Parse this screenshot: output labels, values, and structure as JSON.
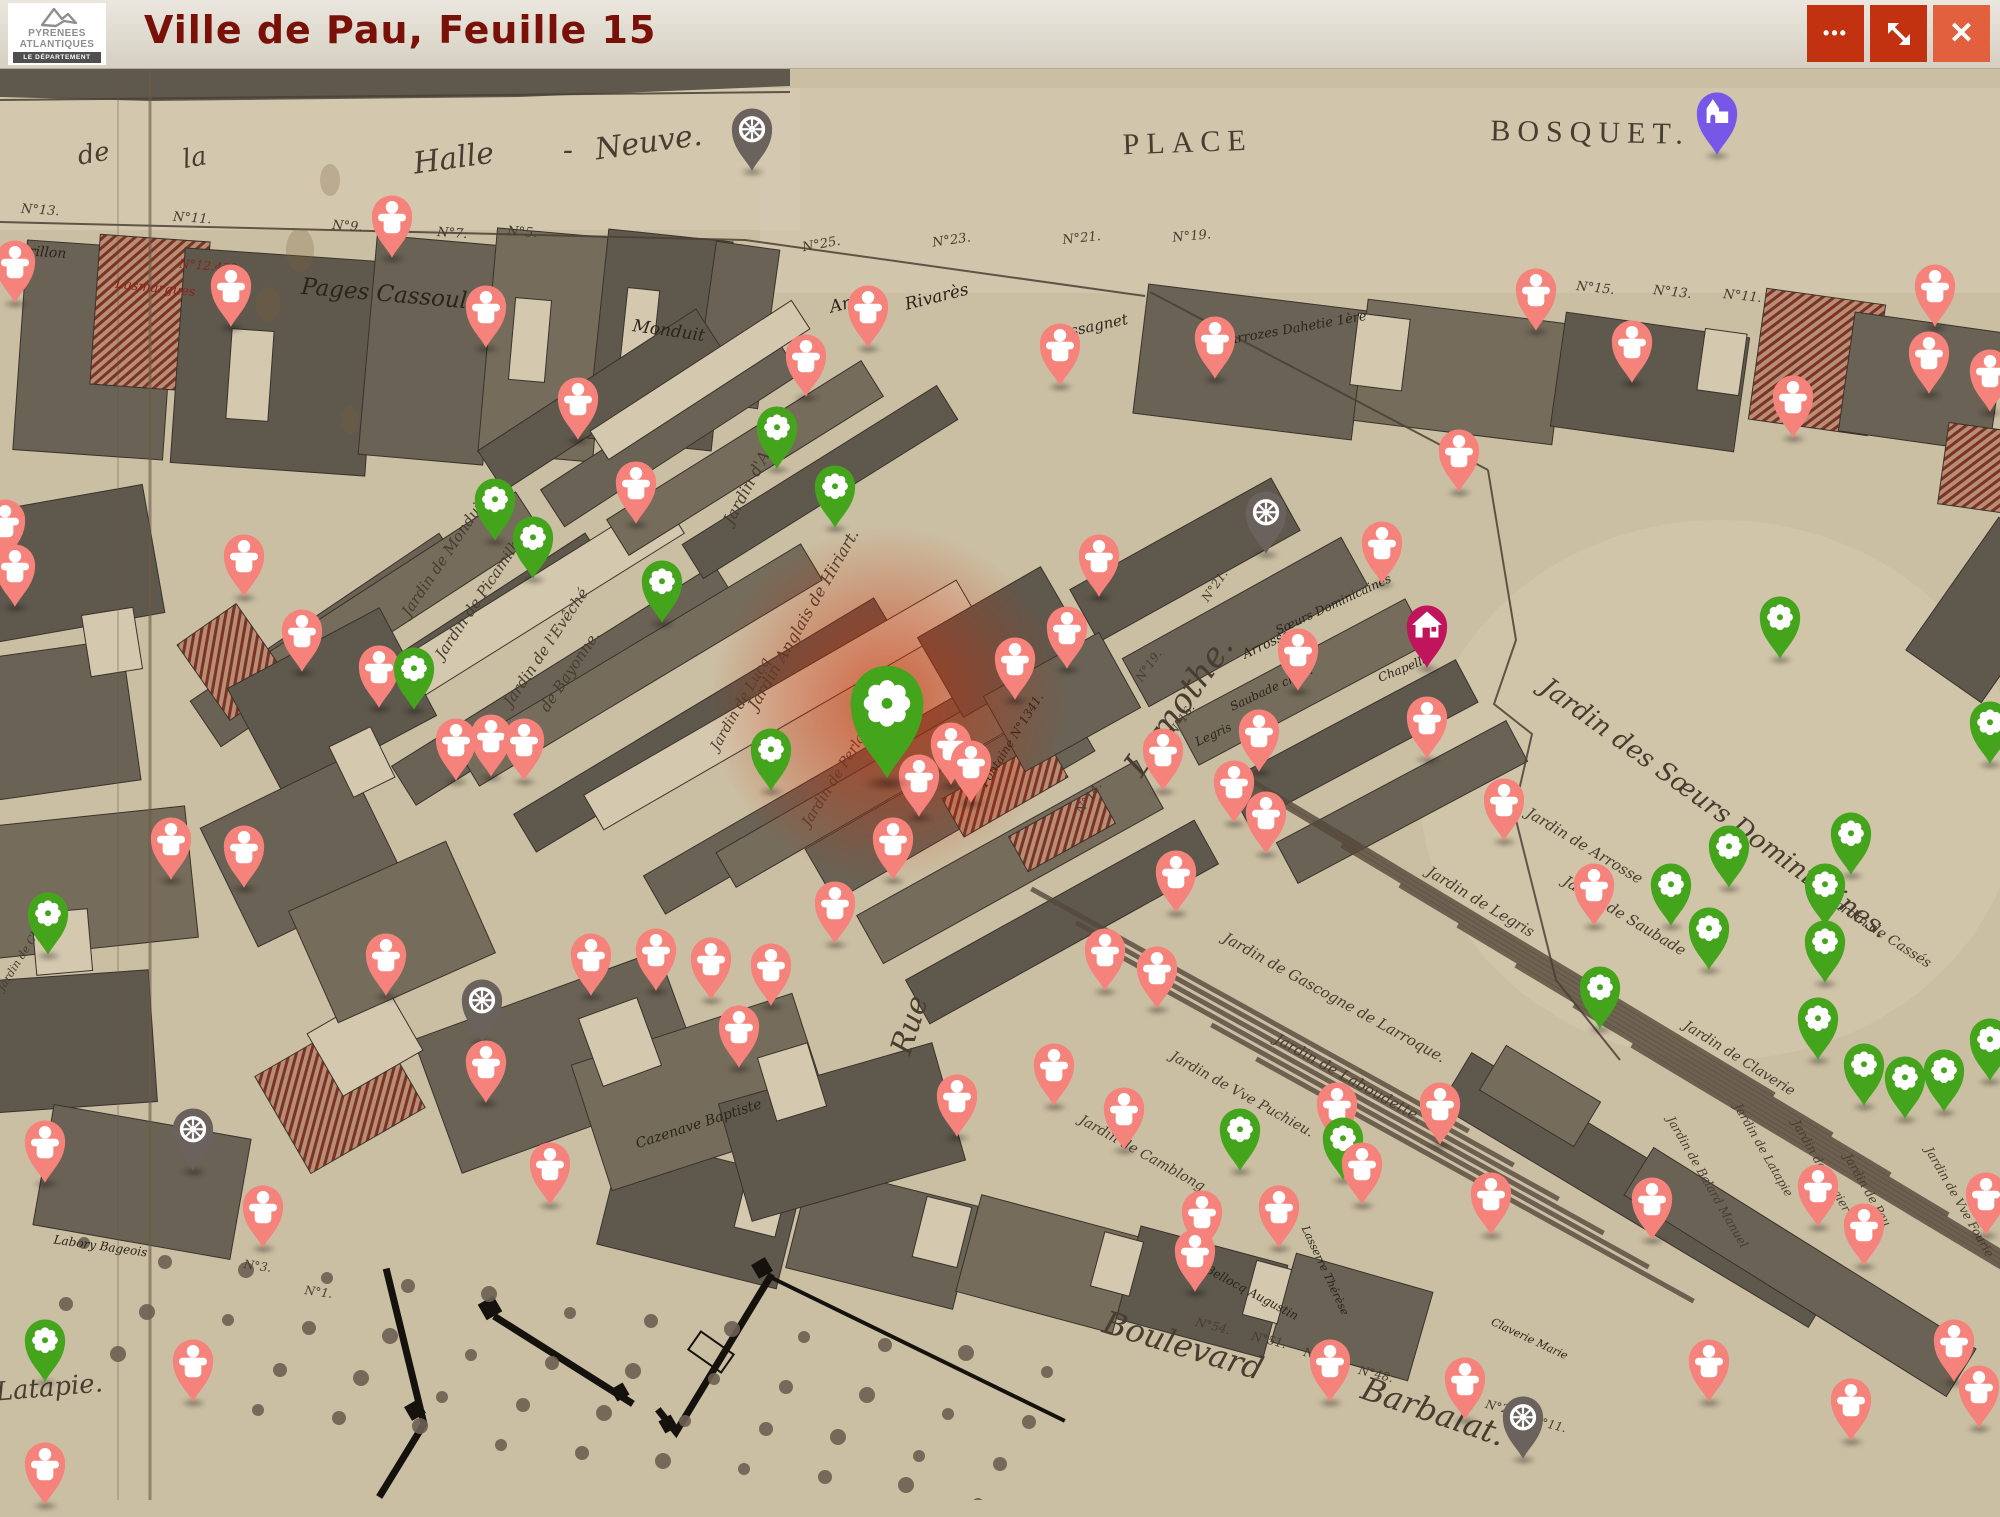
{
  "header": {
    "title": "Ville de Pau, Feuille 15",
    "logo": {
      "line1": "PYRENEES",
      "line2": "ATLANTIQUES",
      "line3": "LE DÉPARTEMENT"
    },
    "controls": {
      "more": {
        "label": "More options",
        "glyph": "•••",
        "icon": "more-options-icon"
      },
      "fullscreen": {
        "label": "Toggle fullscreen",
        "icon": "fullscreen-arrows-icon"
      },
      "close": {
        "label": "Close",
        "glyph": "✕",
        "icon": "close-icon"
      }
    }
  },
  "colors": {
    "header_bg": "#ddd7c9",
    "title": "#7a1108",
    "button": "#c23210",
    "button_close": "#e2603e",
    "paper": "#cbbfa3",
    "ink": "#473d30",
    "pin_person": "#F5837B",
    "pin_flower": "#44A41C",
    "pin_wheel": "#6B625D",
    "pin_church": "#7757E8",
    "pin_house": "#C0155C",
    "highlight_glow": "#CD2A04"
  },
  "map": {
    "labels": [
      [
        "de",
        95,
        162,
        26,
        -10,
        "s"
      ],
      [
        "la",
        196,
        166,
        26,
        -10,
        "s"
      ],
      [
        "Halle",
        455,
        168,
        30,
        -8,
        "s"
      ],
      [
        "-",
        568,
        160,
        30,
        0,
        "s"
      ],
      [
        "Neuve.",
        650,
        152,
        30,
        -8,
        "s"
      ],
      [
        "PLACE",
        1188,
        152,
        30,
        -2,
        "c"
      ],
      [
        "BOSQUET.",
        1590,
        142,
        30,
        1,
        "c"
      ],
      [
        "Pages Cassoulat",
        395,
        302,
        23,
        5,
        "s",
        "d"
      ],
      [
        "Monduit",
        668,
        336,
        17,
        8,
        "s",
        "d"
      ],
      [
        "Arriou",
        858,
        306,
        17,
        -14,
        "s",
        "d"
      ],
      [
        "Rivarès",
        938,
        302,
        17,
        -14,
        "s",
        "d"
      ],
      [
        "Cassagnet",
        1090,
        332,
        15,
        -12,
        "s",
        "d"
      ],
      [
        "Arrozes Dahetie 1ère",
        1298,
        332,
        13,
        -10,
        "s",
        "d"
      ],
      [
        "Merillon",
        36,
        256,
        14,
        4,
        "s",
        "d"
      ],
      [
        "Lasmargues",
        155,
        292,
        13,
        6,
        "s",
        "r"
      ],
      [
        "N°12.433",
        208,
        270,
        12,
        5,
        "n",
        "r"
      ],
      [
        "Lamothe.",
        1188,
        712,
        34,
        -55,
        "s"
      ],
      [
        "Rue",
        919,
        1028,
        30,
        -72,
        "s"
      ],
      [
        "Boulevard",
        1180,
        1356,
        32,
        17,
        "s"
      ],
      [
        "Barbalat.",
        1430,
        1422,
        32,
        19,
        "s"
      ],
      [
        "Latapie.",
        50,
        1396,
        26,
        -5,
        "s"
      ],
      [
        "Jardin des Sœurs Dominicaines.",
        1710,
        815,
        26,
        36,
        "s"
      ],
      [
        "Jardin de Monduit",
        448,
        560,
        15,
        -56,
        "s"
      ],
      [
        "Jardin de Picamilh",
        482,
        602,
        15,
        -56,
        "s"
      ],
      [
        "Jardin de l'Evêché",
        550,
        650,
        15,
        -56,
        "s"
      ],
      [
        "de Bayonne.",
        574,
        674,
        15,
        -56,
        "s"
      ],
      [
        "Jardin d'Arriou.",
        762,
        470,
        16,
        -62,
        "s"
      ],
      [
        "Jardin Anglais de Hiriart.",
        808,
        622,
        16,
        -60,
        "s"
      ],
      [
        "Jardin de Lucq",
        744,
        706,
        14,
        -60,
        "s"
      ],
      [
        "Jardin de Perlat.",
        840,
        778,
        14,
        -58,
        "s"
      ],
      [
        "Fontaine N°1341.",
        1015,
        742,
        12,
        -58,
        "s",
        "d"
      ],
      [
        "Cazenave Baptiste",
        700,
        1128,
        14,
        -18,
        "s",
        "d"
      ],
      [
        "Sœurs Dominicaines",
        1335,
        608,
        12,
        -25,
        "s",
        "d"
      ],
      [
        "Arrosse",
        1268,
        648,
        13,
        -25,
        "s",
        "d"
      ],
      [
        "Saubade chap.",
        1273,
        692,
        12,
        -25,
        "s",
        "d"
      ],
      [
        "Legris",
        1215,
        738,
        12,
        -25,
        "s",
        "d"
      ],
      [
        "Chapelle",
        1405,
        672,
        12,
        -22,
        "s",
        "d"
      ],
      [
        "Jardin de Legris",
        1478,
        906,
        15,
        31,
        "s"
      ],
      [
        "Jardin de Arrosse",
        1582,
        850,
        15,
        31,
        "s"
      ],
      [
        "Jardin de Saubade",
        1622,
        920,
        15,
        31,
        "s"
      ],
      [
        "Jardin de Cassés",
        1878,
        936,
        14,
        33,
        "s"
      ],
      [
        "Jardin de Claverie",
        1737,
        1062,
        14,
        32,
        "s"
      ],
      [
        "Jardin de Gascogne de Larroque.",
        1332,
        1002,
        15,
        29,
        "s"
      ],
      [
        "Jardin de Laboudette.",
        1346,
        1082,
        15,
        29,
        "s"
      ],
      [
        "Jardin de Vve Puchieu.",
        1240,
        1098,
        14,
        29,
        "s"
      ],
      [
        "Jardin de Camblong.",
        1142,
        1158,
        14,
        29,
        "s"
      ],
      [
        "Jardin de Latapie",
        1760,
        1152,
        12,
        60,
        "s"
      ],
      [
        "Jardin de Balard Manuel",
        1704,
        1184,
        12,
        60,
        "s"
      ],
      [
        "Jardin de Vergier",
        1818,
        1168,
        12,
        60,
        "s"
      ],
      [
        "Jardin de Pau",
        1864,
        1192,
        12,
        60,
        "s"
      ],
      [
        "Jardin de Vve Fourie",
        1956,
        1204,
        12,
        60,
        "s"
      ],
      [
        "Bellocq Augustin",
        1250,
        1296,
        12,
        28,
        "s",
        "d"
      ],
      [
        "Lasserre Thérèse",
        1322,
        1272,
        11,
        65,
        "s",
        "d"
      ],
      [
        "Claverie Marie",
        1528,
        1342,
        11,
        25,
        "s",
        "d"
      ],
      [
        "Labory Bageois",
        100,
        1250,
        12,
        8,
        "s",
        "d"
      ],
      [
        "Jardin de Chiche",
        28,
        952,
        11,
        -58,
        "s"
      ],
      [
        "N°13.",
        40,
        214,
        13,
        4,
        "n"
      ],
      [
        "N°11.",
        192,
        222,
        13,
        4,
        "n"
      ],
      [
        "N°9.",
        347,
        230,
        13,
        4,
        "n"
      ],
      [
        "N°7.",
        452,
        237,
        13,
        4,
        "n"
      ],
      [
        "N°5.",
        522,
        236,
        13,
        4,
        "n"
      ],
      [
        "N°25.",
        822,
        248,
        13,
        -10,
        "n"
      ],
      [
        "N°23.",
        952,
        244,
        13,
        -8,
        "n"
      ],
      [
        "N°21.",
        1082,
        242,
        13,
        -6,
        "n"
      ],
      [
        "N°19.",
        1192,
        240,
        13,
        -5,
        "n"
      ],
      [
        "N°15.",
        1595,
        292,
        13,
        6,
        "n"
      ],
      [
        "N°13.",
        1672,
        296,
        13,
        6,
        "n"
      ],
      [
        "N°11.",
        1742,
        300,
        13,
        6,
        "n"
      ],
      [
        "N°21.",
        1218,
        588,
        12,
        -55,
        "n"
      ],
      [
        "N°19.",
        1152,
        668,
        12,
        -55,
        "n"
      ],
      [
        "N°16.",
        1185,
        722,
        12,
        -55,
        "n"
      ],
      [
        "N°14.",
        1092,
        800,
        12,
        -55,
        "n"
      ],
      [
        "N°54.",
        1212,
        1330,
        12,
        14,
        "n"
      ],
      [
        "N°51.",
        1268,
        1344,
        12,
        14,
        "n"
      ],
      [
        "N°50.",
        1320,
        1360,
        12,
        14,
        "n"
      ],
      [
        "N°48.",
        1375,
        1378,
        12,
        14,
        "n"
      ],
      [
        "N°24.",
        1502,
        1412,
        12,
        14,
        "n"
      ],
      [
        "N°11.",
        1548,
        1428,
        12,
        14,
        "n"
      ],
      [
        "N°3.",
        257,
        1270,
        12,
        8,
        "n"
      ],
      [
        "N°1.",
        318,
        1296,
        12,
        8,
        "n"
      ]
    ]
  },
  "pins": {
    "types": {
      "p": {
        "name": "person",
        "icon": "person-icon"
      },
      "f": {
        "name": "garden-works",
        "icon": "flower-icon"
      },
      "F": {
        "name": "garden-works-highlighted",
        "icon": "flower-icon"
      },
      "w": {
        "name": "transport",
        "icon": "wheel-icon"
      },
      "c": {
        "name": "church",
        "icon": "church-icon"
      },
      "h": {
        "name": "house",
        "icon": "house-icon"
      }
    },
    "items": [
      [
        "w",
        752,
        129
      ],
      [
        "c",
        1717,
        113
      ],
      [
        "p",
        392,
        216
      ],
      [
        "p",
        15,
        261
      ],
      [
        "p",
        231,
        285
      ],
      [
        "p",
        486,
        306
      ],
      [
        "p",
        868,
        306
      ],
      [
        "p",
        1536,
        289
      ],
      [
        "p",
        1935,
        285
      ],
      [
        "p",
        1929,
        352
      ],
      [
        "p",
        1215,
        337
      ],
      [
        "p",
        1060,
        344
      ],
      [
        "p",
        1632,
        341
      ],
      [
        "p",
        806,
        355
      ],
      [
        "p",
        1990,
        370
      ],
      [
        "p",
        1793,
        396
      ],
      [
        "p",
        578,
        398
      ],
      [
        "f",
        777,
        427
      ],
      [
        "p",
        1459,
        450
      ],
      [
        "f",
        835,
        486
      ],
      [
        "f",
        495,
        499
      ],
      [
        "p",
        636,
        482
      ],
      [
        "f",
        533,
        537
      ],
      [
        "w",
        1266,
        512
      ],
      [
        "p",
        5,
        520
      ],
      [
        "p",
        244,
        555
      ],
      [
        "p",
        1382,
        542
      ],
      [
        "p",
        1099,
        555
      ],
      [
        "f",
        662,
        581
      ],
      [
        "p",
        379,
        666
      ],
      [
        "f",
        414,
        668
      ],
      [
        "p",
        302,
        630
      ],
      [
        "p",
        1067,
        627
      ],
      [
        "h",
        1427,
        626
      ],
      [
        "f",
        1780,
        617
      ],
      [
        "p",
        1015,
        658
      ],
      [
        "p",
        1298,
        649
      ],
      [
        "p",
        15,
        565
      ],
      [
        "F",
        887,
        704
      ],
      [
        "p",
        951,
        743
      ],
      [
        "p",
        456,
        739
      ],
      [
        "p",
        491,
        735
      ],
      [
        "p",
        524,
        739
      ],
      [
        "f",
        771,
        749
      ],
      [
        "p",
        1163,
        749
      ],
      [
        "p",
        1259,
        730
      ],
      [
        "p",
        1427,
        717
      ],
      [
        "f",
        1990,
        722
      ],
      [
        "p",
        971,
        761
      ],
      [
        "p",
        1234,
        781
      ],
      [
        "p",
        919,
        775
      ],
      [
        "p",
        171,
        838
      ],
      [
        "p",
        244,
        846
      ],
      [
        "p",
        893,
        838
      ],
      [
        "p",
        1266,
        812
      ],
      [
        "p",
        1504,
        799
      ],
      [
        "p",
        1176,
        871
      ],
      [
        "f",
        48,
        913
      ],
      [
        "p",
        835,
        902
      ],
      [
        "p",
        1594,
        884
      ],
      [
        "f",
        1729,
        846
      ],
      [
        "f",
        1671,
        884
      ],
      [
        "f",
        1825,
        884
      ],
      [
        "f",
        1709,
        928
      ],
      [
        "f",
        1851,
        833
      ],
      [
        "p",
        386,
        954
      ],
      [
        "p",
        591,
        954
      ],
      [
        "p",
        656,
        949
      ],
      [
        "p",
        711,
        958
      ],
      [
        "p",
        771,
        964
      ],
      [
        "p",
        1105,
        949
      ],
      [
        "p",
        1157,
        967
      ],
      [
        "f",
        1600,
        987
      ],
      [
        "f",
        1825,
        941
      ],
      [
        "w",
        482,
        1000
      ],
      [
        "p",
        739,
        1026
      ],
      [
        "f",
        1818,
        1018
      ],
      [
        "p",
        486,
        1061
      ],
      [
        "p",
        1054,
        1064
      ],
      [
        "p",
        957,
        1095
      ],
      [
        "p",
        1124,
        1108
      ],
      [
        "f",
        1864,
        1064
      ],
      [
        "f",
        1905,
        1077
      ],
      [
        "f",
        1944,
        1070
      ],
      [
        "f",
        1990,
        1039
      ],
      [
        "p",
        1440,
        1103
      ],
      [
        "f",
        1240,
        1129
      ],
      [
        "p",
        1337,
        1103
      ],
      [
        "f",
        1343,
        1138
      ],
      [
        "p",
        1362,
        1163
      ],
      [
        "w",
        193,
        1129
      ],
      [
        "p",
        45,
        1141
      ],
      [
        "p",
        1202,
        1211
      ],
      [
        "p",
        1279,
        1206
      ],
      [
        "p",
        1195,
        1250
      ],
      [
        "p",
        1491,
        1193
      ],
      [
        "p",
        1652,
        1198
      ],
      [
        "p",
        1818,
        1185
      ],
      [
        "p",
        1864,
        1224
      ],
      [
        "p",
        1986,
        1193
      ],
      [
        "p",
        263,
        1206
      ],
      [
        "p",
        550,
        1163
      ],
      [
        "p",
        193,
        1360
      ],
      [
        "f",
        45,
        1340
      ],
      [
        "p",
        1330,
        1360
      ],
      [
        "p",
        1465,
        1378
      ],
      [
        "w",
        1523,
        1417
      ],
      [
        "p",
        1709,
        1360
      ],
      [
        "p",
        1851,
        1399
      ],
      [
        "p",
        1979,
        1386
      ],
      [
        "p",
        45,
        1463
      ],
      [
        "p",
        1954,
        1340
      ]
    ]
  }
}
